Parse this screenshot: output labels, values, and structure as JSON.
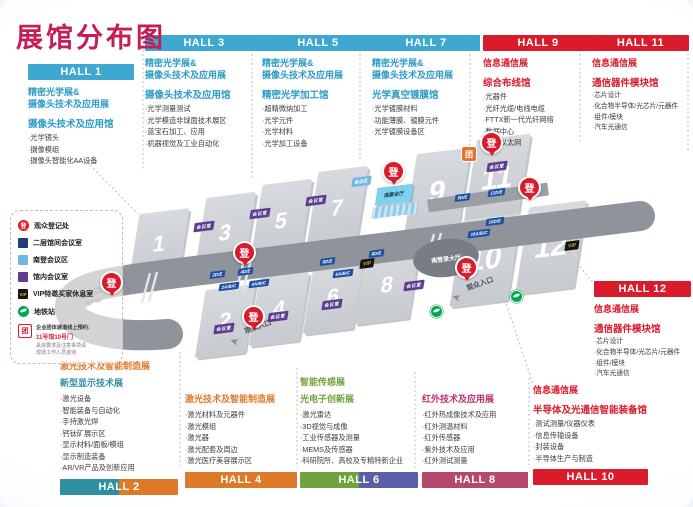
{
  "colors": {
    "magenta": "#c51e56",
    "cyan": "#2b9cc6",
    "cyan_bar": "#3fa8d0",
    "red": "#da1b2c",
    "orange": "#dd7a28",
    "teal": "#2e8fa3",
    "green": "#6fa23c",
    "purple_bar": "#5b5ea6",
    "rose_bar": "#b5496b",
    "rose_text": "#bf3069",
    "badge_purple": "#5e3d91",
    "label_blue": "#1f4fa0",
    "legend_navy": "#1f3d7a",
    "legend_lightblue": "#6fb7e3",
    "metro_green": "#00a650",
    "vip_gold": "#d8a63a"
  },
  "title": "展馆分布图",
  "blocks": {
    "h1": {
      "label": "HALL 1",
      "show1": "精密光学展&",
      "show2": "摄像头技术及应用展",
      "venue": "摄像头技术及应用馆",
      "items": [
        "·光学镜头",
        "·摄像模组",
        "·摄像头智能化AA设备"
      ]
    },
    "h3": {
      "label": "HALL 3",
      "show1": "精密光学展&",
      "show2": "摄像头技术及应用展",
      "venue": "摄像头技术及应用馆",
      "items": [
        "·光学测量测试",
        "·光学模造非球面技术展区",
        "·蓝宝石加工、应用",
        "·机器视觉及工业自动化"
      ]
    },
    "h5": {
      "label": "HALL 5",
      "show1": "精密光学展&",
      "show2": "摄像头技术及应用展",
      "venue": "精密光学加工馆",
      "items": [
        "·超精微纳加工",
        "·光学元件",
        "·光学材料",
        "·光学加工设备"
      ]
    },
    "h7": {
      "label": "HALL 7",
      "show1": "精密光学展&",
      "show2": "摄像头技术及应用展",
      "venue": "光学真空镀膜馆",
      "items": [
        "·光学镀膜材料",
        "·功能薄膜、镀膜元件",
        "·光学镀膜设备区"
      ]
    },
    "h9": {
      "label": "HALL 9",
      "show1": "信息通信展",
      "venue": "综合布线馆",
      "items": [
        "·光器件",
        "·光纤光缆/电线电缆",
        "·FTTX新一代光纤网络",
        "·数据中心",
        "·车载以太网"
      ]
    },
    "h11": {
      "label": "HALL 11",
      "show1": "信息通信展",
      "venue": "通信器件模块馆",
      "items": [
        "·芯片设计",
        "·化合物半导体/光芯片/元器件",
        "·组件/模块",
        "·汽车光通信"
      ]
    },
    "h12": {
      "label": "HALL 12",
      "show1": "信息通信展",
      "venue": "通信器件模块馆",
      "items": [
        "·芯片设计",
        "·化合物半导体/光芯片/元器件",
        "·组件/模块",
        "·汽车光通信"
      ]
    },
    "h2": {
      "label": "HALL 2",
      "show1": "激光技术及智能制造展",
      "show2": "新型显示技术展",
      "items": [
        "·激光设备",
        "·智能装备与自动化",
        "·手持激光焊",
        "·钙钛矿展示区",
        "·显示材料/面板/模组",
        "·显示制造装备",
        "·AR/VR产品及创新应用"
      ]
    },
    "h4": {
      "label": "HALL 4",
      "show1": "激光技术及智能制造展",
      "items": [
        "·激光材料及元器件",
        "·激光模组",
        "·激光器",
        "·激光配套及周边",
        "·激光医疗美容展示区"
      ]
    },
    "h6": {
      "label": "HALL 6",
      "show1": "智能传感展",
      "show2": "光电子创新展",
      "items": [
        "·激光雷达",
        "·3D视觉与成像",
        "·工业传感器及测量",
        "·MEMS及传感器",
        "·科研院所、高校及专精特新企业"
      ]
    },
    "h8": {
      "label": "HALL 8",
      "show1": "红外技术及应用展",
      "items": [
        "·红外热成像技术及应用",
        "·红外测温材料",
        "·红外传感器",
        "·紫外技术及应用",
        "·红外测试测量"
      ]
    },
    "h10": {
      "label": "HALL 10",
      "show1": "信息通信展",
      "venue": "半导体及光通信智能装备馆",
      "items": [
        "·测试测量/仪器仪表",
        "·信息传输设备",
        "·封装设备",
        "·半导体生产与制造"
      ]
    }
  },
  "legend": {
    "items": [
      {
        "label": "观众登记处"
      },
      {
        "label": "二层馆间会议室"
      },
      {
        "label": "南登会议区"
      },
      {
        "label": "馆内会议室"
      },
      {
        "label": "VIP特邀买家休息室"
      },
      {
        "label": "地铁站"
      }
    ],
    "note1": "企业团体通道线上预约:",
    "note2": "11号馆10号门",
    "note3": "具体要求及注意事项请",
    "note4": "现场工作人员咨询"
  },
  "map": {
    "hall_numbers": [
      "1",
      "2",
      "3",
      "4",
      "5",
      "6",
      "7",
      "8",
      "9",
      "10",
      "11",
      "12"
    ],
    "badge_deng": "登",
    "badge_tuan": "团",
    "badge_vip": "VIP",
    "badge_meeting": "会议室",
    "badge_meeting_area": "会议区",
    "banquet": "南宴会厅",
    "reg_hall": "南登录大厅",
    "south_entrance": "南入口",
    "south_entrance_sub": "(南广场)",
    "visitor_entrance": "观众入口",
    "zones": [
      "2D/E",
      "4D/E",
      "2A/B/C",
      "4A/B/C",
      "6D/E",
      "8D/E",
      "6A/B/C",
      "9D/E",
      "11D/E",
      "10D/E",
      "10A/B/C"
    ]
  }
}
